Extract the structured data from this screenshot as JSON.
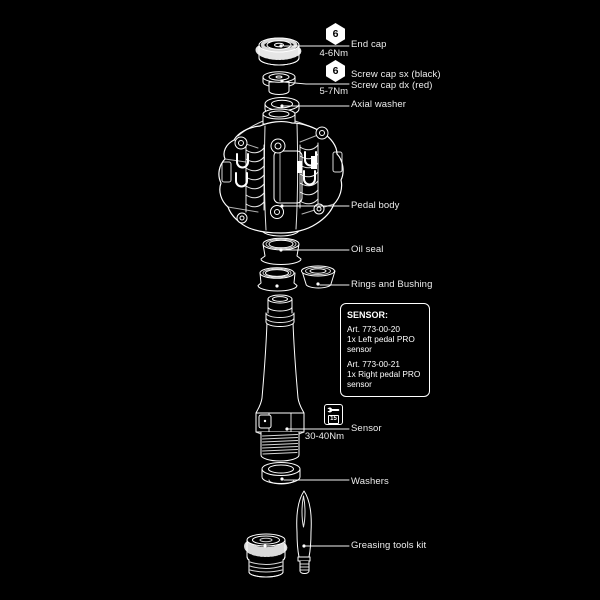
{
  "colors": {
    "background": "#000000",
    "line": "#ffffff",
    "text": "#ededed"
  },
  "parts": {
    "end_cap": {
      "label": "End cap",
      "torque": "4-6Nm",
      "tool": "6"
    },
    "screw_cap": {
      "label_sx": "Screw cap sx (black)",
      "label_dx": "Screw cap dx (red)",
      "torque": "5-7Nm",
      "tool": "6"
    },
    "axial_washer": {
      "label": "Axial washer"
    },
    "pedal_body": {
      "label": "Pedal body"
    },
    "oil_seal": {
      "label": "Oil seal"
    },
    "rings_bushing": {
      "label": "Rings and Bushing"
    },
    "sensor": {
      "label": "Sensor",
      "torque": "30-40Nm",
      "tool": "15"
    },
    "washers": {
      "label": "Washers"
    },
    "greasing_kit": {
      "label": "Greasing tools kit"
    }
  },
  "sensor_box": {
    "title": "SENSOR:",
    "items": [
      {
        "art": "Art. 773-00-20",
        "desc": "1x Left pedal PRO sensor"
      },
      {
        "art": "Art. 773-00-21",
        "desc": "1x Right pedal PRO sensor"
      }
    ]
  }
}
